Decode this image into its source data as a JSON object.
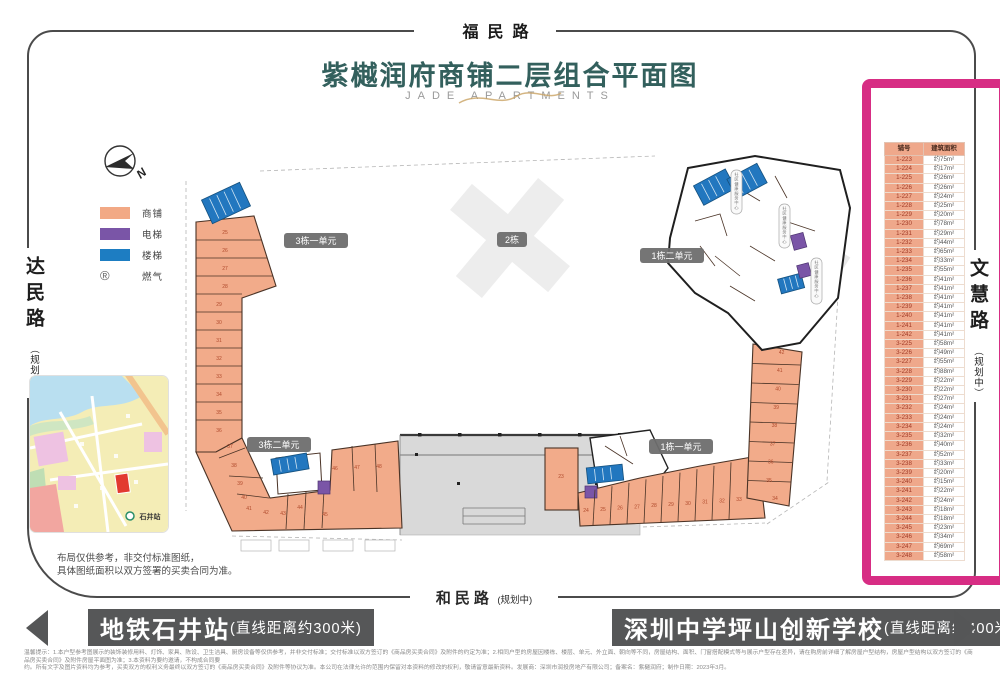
{
  "roads": {
    "top": "福民路",
    "bottom": "和民路",
    "bottom_sub": "(规划中)",
    "left": "达民路",
    "left_sub": "（规划中）",
    "right": "文慧路",
    "right_sub": "（规划中）"
  },
  "title": {
    "cn": "紫樾润府商铺二层组合平面图",
    "en": "JADE APARTMENTS"
  },
  "legend": {
    "compass_north": "N",
    "items": [
      {
        "label": "商铺",
        "color": "#f2a985"
      },
      {
        "label": "电梯",
        "color": "#7a55a7"
      },
      {
        "label": "楼梯",
        "color": "#1d7dc2"
      },
      {
        "label": "燃气",
        "symbol": "®"
      }
    ]
  },
  "plan": {
    "badges": [
      "3栋一单元",
      "2栋",
      "1栋二单元",
      "3栋二单元",
      "1栋一单元"
    ],
    "service_label": "社区健康服务中心",
    "shops": {
      "left": [
        "25",
        "26",
        "27",
        "28",
        "29",
        "30",
        "31",
        "32",
        "33",
        "34",
        "35",
        "36"
      ],
      "bottom_left": [
        "37",
        "38",
        "39",
        "40",
        "41",
        "42",
        "43",
        "44",
        "45",
        "46",
        "47",
        "48"
      ],
      "right_row": [
        "24",
        "25",
        "26",
        "27",
        "28",
        "29",
        "30",
        "31",
        "32",
        "33"
      ],
      "right_col": [
        "35",
        "36",
        "37",
        "38",
        "39",
        "40",
        "41",
        "42"
      ],
      "corner": "34",
      "tall": "23"
    }
  },
  "map": {
    "station_label": "石井站"
  },
  "note": {
    "line1": "布局仅供参考，非交付标准图纸，",
    "line2": "具体图纸面积以双方签署的买卖合同为准。"
  },
  "table": {
    "headers": [
      "铺号",
      "建筑面积"
    ],
    "rows": [
      [
        "1-223",
        "约75m²"
      ],
      [
        "1-224",
        "约17m²"
      ],
      [
        "1-225",
        "约26m²"
      ],
      [
        "1-226",
        "约26m²"
      ],
      [
        "1-227",
        "约24m²"
      ],
      [
        "1-228",
        "约25m²"
      ],
      [
        "1-229",
        "约20m²"
      ],
      [
        "1-230",
        "约78m²"
      ],
      [
        "1-231",
        "约29m²"
      ],
      [
        "1-232",
        "约44m²"
      ],
      [
        "1-233",
        "约65m²"
      ],
      [
        "1-234",
        "约33m²"
      ],
      [
        "1-235",
        "约55m²"
      ],
      [
        "1-236",
        "约41m²"
      ],
      [
        "1-237",
        "约41m²"
      ],
      [
        "1-238",
        "约41m²"
      ],
      [
        "1-239",
        "约41m²"
      ],
      [
        "1-240",
        "约41m²"
      ],
      [
        "1-241",
        "约41m²"
      ],
      [
        "1-242",
        "约41m²"
      ],
      [
        "3-225",
        "约58m²"
      ],
      [
        "3-226",
        "约49m²"
      ],
      [
        "3-227",
        "约55m²"
      ],
      [
        "3-228",
        "约88m²"
      ],
      [
        "3-229",
        "约22m²"
      ],
      [
        "3-230",
        "约22m²"
      ],
      [
        "3-231",
        "约27m²"
      ],
      [
        "3-232",
        "约24m²"
      ],
      [
        "3-233",
        "约24m²"
      ],
      [
        "3-234",
        "约24m²"
      ],
      [
        "3-235",
        "约32m²"
      ],
      [
        "3-236",
        "约40m²"
      ],
      [
        "3-237",
        "约52m²"
      ],
      [
        "3-238",
        "约33m²"
      ],
      [
        "3-239",
        "约20m²"
      ],
      [
        "3-240",
        "约15m²"
      ],
      [
        "3-241",
        "约22m²"
      ],
      [
        "3-242",
        "约24m²"
      ],
      [
        "3-243",
        "约18m²"
      ],
      [
        "3-244",
        "约18m²"
      ],
      [
        "3-245",
        "约23m²"
      ],
      [
        "3-246",
        "约34m²"
      ],
      [
        "3-247",
        "约69m²"
      ],
      [
        "3-248",
        "约58m²"
      ]
    ]
  },
  "footer": {
    "left": {
      "title": "地铁石井站",
      "sub": "(直线距离约300米)"
    },
    "right": {
      "title": "深圳中学坪山创新学校",
      "sub": "(直线距离约400米)"
    }
  },
  "disclaimer": {
    "line1": "温馨提示：1.本户型参考图展示的装饰装修用料、灯饰、家具、陈设、卫生洁具、厨房设备等仅供参考，并非交付标准；交付标准以双方签订的《商品房买卖合同》及附件的约定为准；2.相同户型的房屋因楼栋、楼层、单元、外立面、朝向等不同，房屋结构、面积、门窗搭配模式等与展示户型存在差异，请在购房前详细了解房屋户型结构，房屋户型结构以双方签订的《商品房买卖合同》及附件房屋平面图为准；3.本资料为要约邀请，不构成合同要",
    "line2": "约。所有文字及图片资料均为参考，买卖双方的权利义务最终以双方签订的《商品房买卖合同》及附件等协议为准。本公司在法律允许的范围内保留对本资料的修改的权利，敬请留意最新资料。发展商：深圳市润投房地产有限公司；备案名：紫樾润府；制作日期：2023年3月。"
  }
}
